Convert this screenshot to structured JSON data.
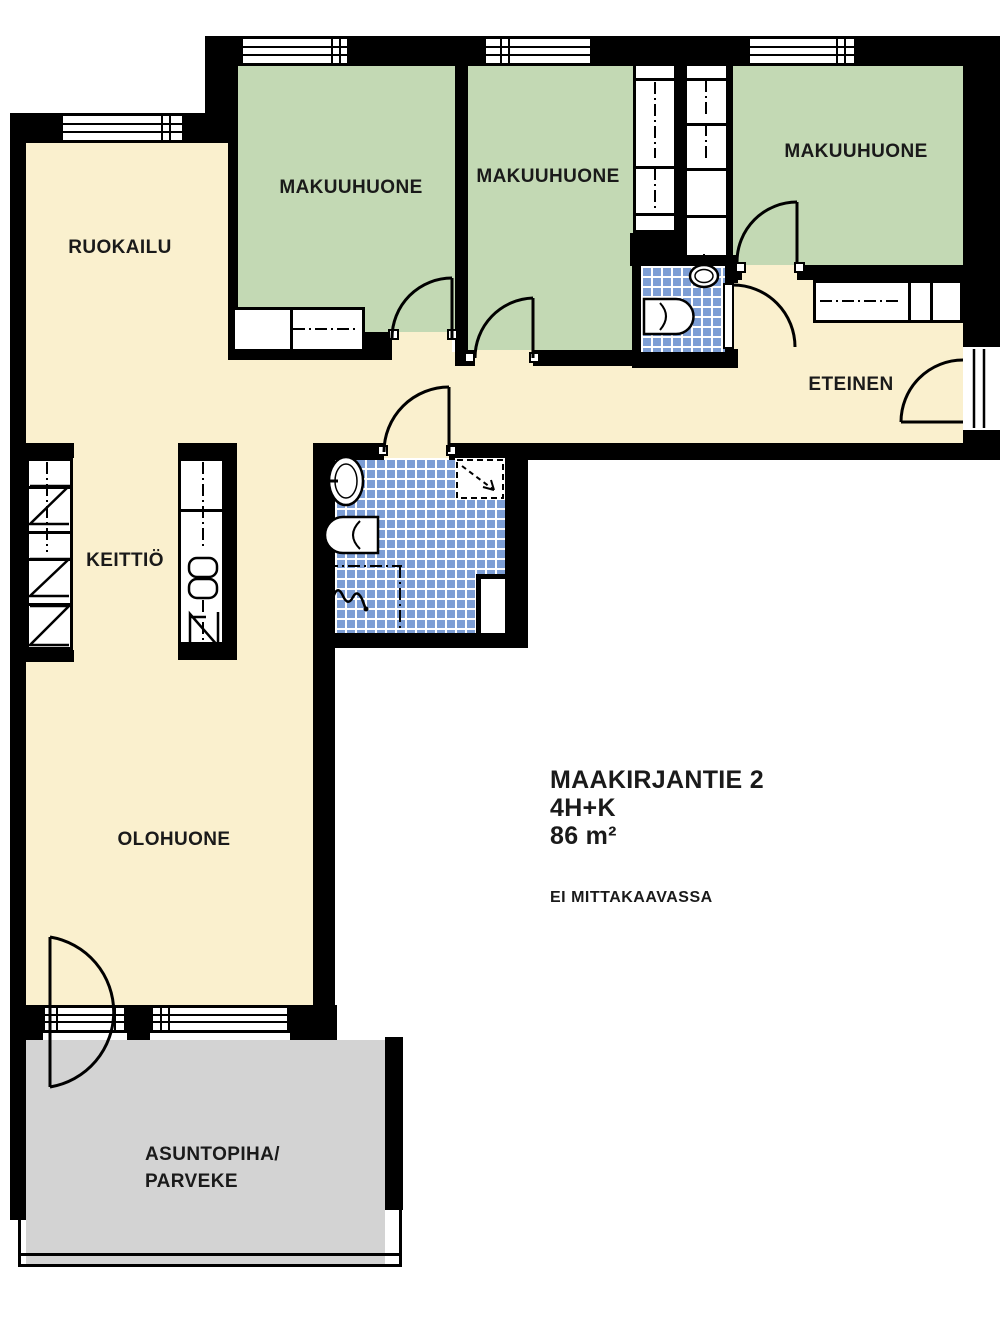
{
  "title": "MAAKIRJANTIE 2 floor plan",
  "rooms": {
    "ruokailu": {
      "label": "RUOKAILU",
      "floor": "cream"
    },
    "makuuhuone_left": {
      "label": "MAKUUHUONE",
      "floor": "green"
    },
    "makuuhuone_middle": {
      "label": "MAKUUHUONE",
      "floor": "green"
    },
    "makuuhuone_right": {
      "label": "MAKUUHUONE",
      "floor": "green"
    },
    "eteinen": {
      "label": "ETEINEN",
      "floor": "cream"
    },
    "keittio": {
      "label": "KEITTIÖ",
      "floor": "cream"
    },
    "olohuone": {
      "label": "OLOHUONE",
      "floor": "cream"
    },
    "kylpyhuone": {
      "label": "",
      "floor": "blue-tile"
    },
    "wc": {
      "label": "",
      "floor": "blue-tile"
    },
    "asuntopiha": {
      "label": "ASUNTOPIHA/",
      "label2": "PARVEKE",
      "floor": "gray"
    }
  },
  "info": {
    "address": "MAAKIRJANTIE 2",
    "layout": "4H+K",
    "area": "86 m²",
    "scale_note": "EI MITTAKAAVASSA"
  },
  "colors": {
    "floor_cream": "#FAF0CE",
    "room_green": "#C3D9B4",
    "tile_blue": "#7D9ED5",
    "balcony_gray": "#D3D3D3",
    "wall_black": "#000000",
    "text": "#1A1A1A"
  }
}
